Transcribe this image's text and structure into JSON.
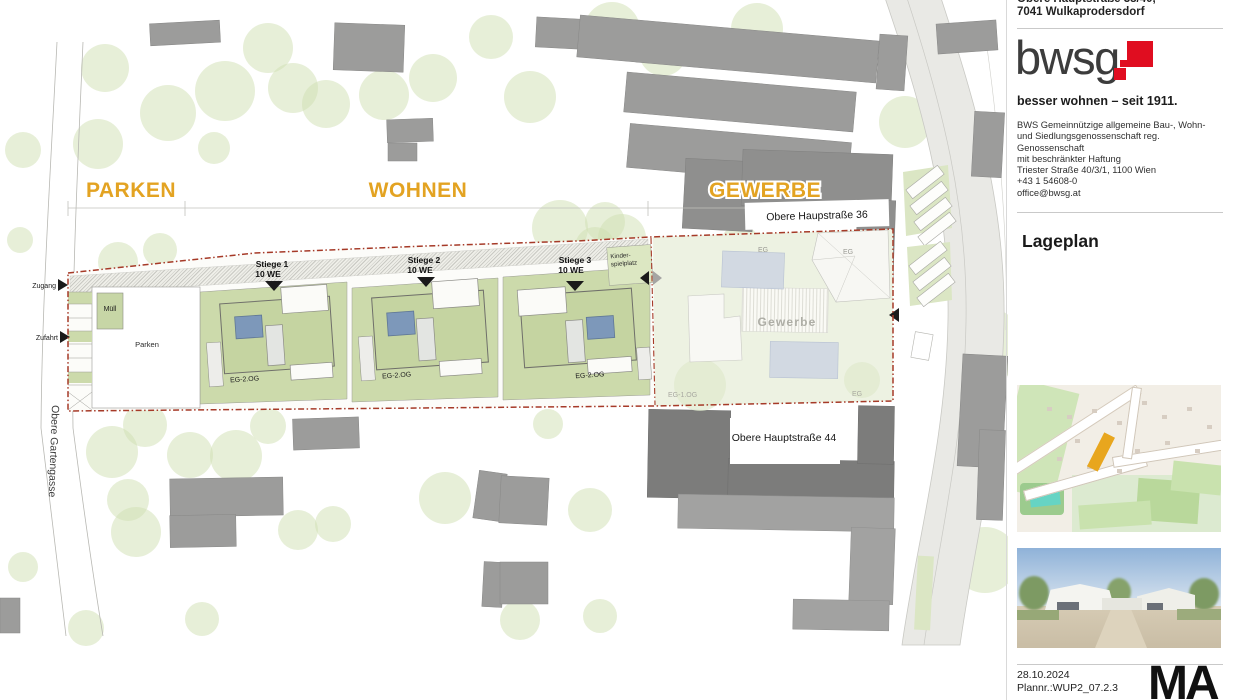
{
  "document": {
    "address": {
      "line1": "Obere Hauptstraße 38/40,",
      "line2": "7041 Wulkaprodersdorf"
    },
    "logo": {
      "text": "bwsg",
      "tagline": "besser wohnen – seit 1911."
    },
    "company": {
      "lines": [
        "BWS Gemeinnützige allgemeine Bau-, Wohn-",
        "und Siedlungsgenossenschaft reg.",
        "Genossenschaft",
        "mit beschränkter Haftung",
        "Triester Straße 40/3/1, 1100 Wien",
        "+43 1 54608-0",
        "office@bwsg.at"
      ]
    },
    "section_title": "Lageplan",
    "footer": {
      "date": "28.10.2024",
      "plan_number": "Plannr.:WUP2_07.2.3",
      "corner_mark": "MA"
    }
  },
  "plan": {
    "zones": {
      "parken": "PARKEN",
      "wohnen": "WOHNEN",
      "gewerbe": "GEWERBE"
    },
    "streets": {
      "hauptstrasse36": "Obere Haupstraße 36",
      "hauptstrasse44": "Obere Hauptstraße 44",
      "gartengasse": "Obere Gartengasse"
    },
    "access": {
      "zugang": "Zugang",
      "zufahrt": "Zufahrt"
    },
    "areas": {
      "muell": "Müll",
      "parken": "Parken",
      "gewerbe": "Gewerbe",
      "kinderspielplatz_line1": "Kinder-",
      "kinderspielplatz_line2": "spielplatz"
    },
    "stiegen": [
      {
        "name": "Stiege 1",
        "units": "10 WE",
        "floors": "EG-2.OG"
      },
      {
        "name": "Stiege 2",
        "units": "10 WE",
        "floors": "EG-2.OG"
      },
      {
        "name": "Stiege 3",
        "units": "10 WE",
        "floors": "EG-2.OG"
      }
    ],
    "floor_labels": {
      "eg_top_left": "EG",
      "eg_top_right": "EG",
      "eg_1og": "EG-1.OG",
      "eg_bottom": "EG"
    },
    "colors": {
      "zone_label": "#e3a322",
      "boundary": "#a63a28",
      "garden_green": "#ccdaab",
      "panel_blue": "#7d98ba",
      "tree_green": "#cfe0b2",
      "building_gray": "#9c9c9b"
    }
  }
}
